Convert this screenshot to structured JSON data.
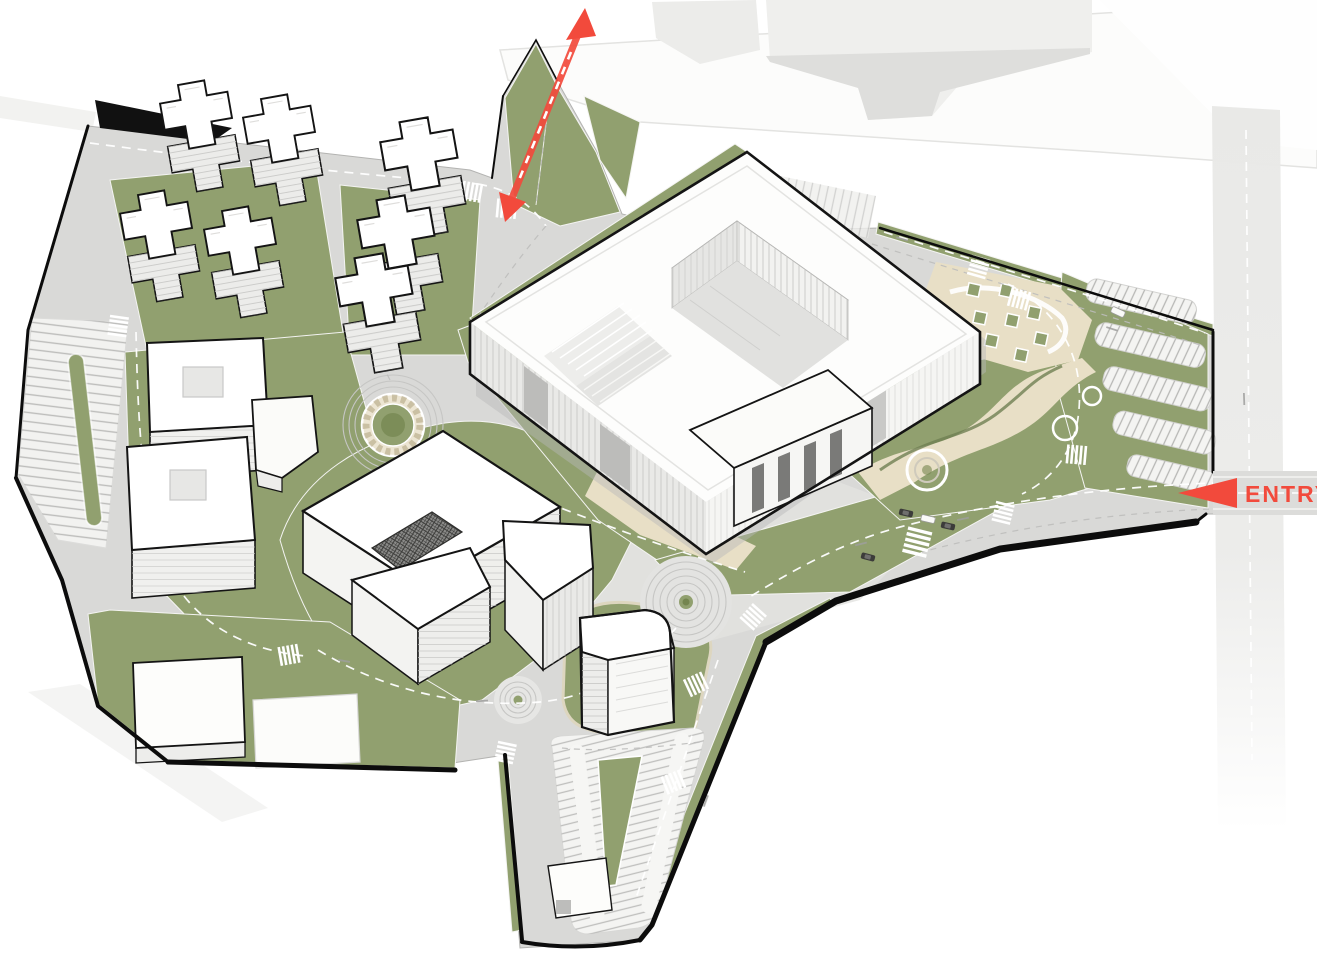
{
  "page": {
    "title": "Architectural masterplan — axonometric site rendering",
    "view": "aerial axonometric",
    "background": "white"
  },
  "labels": {
    "entry": "ENTRY"
  },
  "annotations": {
    "entry_marker": {
      "label": "ENTRY",
      "arrow_direction": "left",
      "color": "#f24a3c",
      "location": "right edge, main vehicular entry road"
    },
    "axis_arrow": {
      "type": "double-headed dashed arrow",
      "color": "#f24a3c",
      "location": "top, secondary access axis through green wedge"
    }
  },
  "colors": {
    "accent": "#f24a3c",
    "grass": "#91a06f",
    "grass_dark": "#74854f",
    "plaza_paving": "#e8dfc6",
    "road": "#d9d9d7",
    "building_white": "#fdfdfc",
    "building_shade": "#ededeb",
    "site_outline": "#141414"
  },
  "site": {
    "buildings": [
      "residential-towers-cluster (7 cruciform high-rise blocks, north-west)",
      "courtyard-box-building-upper (square atrium void)",
      "courtyard-box-building-lower (square atrium void)",
      "small-angled-annex",
      "c-shaped-office-building (central, dark gridded courtyard)",
      "main-headquarters-building (large block with inner courtyard, glass facades, entry steps)",
      "south-tower (rounded corner, on green mound)",
      "low-slab-building-southwest",
      "flat-pad-southwest",
      "parking-kiosk-south",
      "context-buildings-north (faded, off-site)"
    ],
    "landscape": [
      "green-wedge-north (crossed by red axis arrow)",
      "ornamental-roundabout (patterned ring, green center)",
      "concentric-ring-plaza-large",
      "concentric-ring-plaza-small",
      "serpentine-garden-east (curved paved paths, ring nodes)",
      "planter-grid-plaza-northeast",
      "perimeter-lawns-and-verges"
    ],
    "parking": [
      "linear-parking-lot-west (central green island)",
      "parking-rows-east (5 bays in lawn)",
      "v-shaped-parking-lot-south (central green wedge)",
      "small-parking-strip-north"
    ],
    "roads": [
      "entry-avenue-east (dual lanes, crosswalks, cars)",
      "north-east-boundary-road",
      "residential-loop-north-west",
      "central-loop-around-c-building",
      "south-service-corridor",
      "offsite-ghost-road-east (faded)"
    ]
  }
}
